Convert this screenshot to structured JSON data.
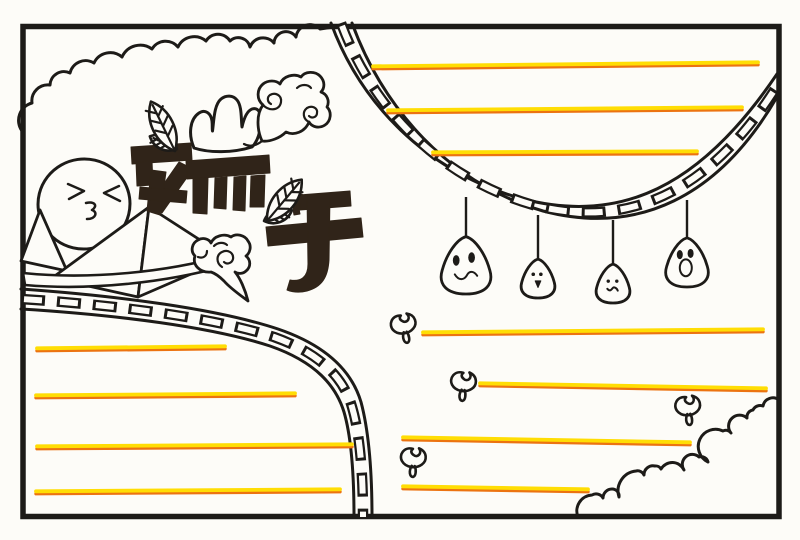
{
  "meta": {
    "title_text": "端午",
    "title_meaning": "Duanwu (Dragon Boat Festival) hand-drawn newspaper template",
    "artwork_kind": "black-ink doodle border page with blank writing lines"
  },
  "palette": {
    "paper": "#fdfcf8",
    "ink": "#1d1b18",
    "title_ink": "#302419",
    "line_yellow": "#ffdd04",
    "line_orange": "#ec7311"
  },
  "frame": {
    "x": 23,
    "y": 26.5,
    "w": 756,
    "h": 490,
    "stroke_w": 5.5
  },
  "writing_lines": {
    "top_right": [
      {
        "x1": 373,
        "y1": 67,
        "x2": 758,
        "y2": 63
      },
      {
        "x1": 388,
        "y1": 111,
        "x2": 742,
        "y2": 108
      },
      {
        "x1": 433,
        "y1": 153,
        "x2": 697,
        "y2": 152
      }
    ],
    "mid_right": [
      {
        "x1": 423,
        "y1": 333,
        "x2": 763,
        "y2": 330
      }
    ],
    "bottom_right": [
      {
        "x1": 480,
        "y1": 384,
        "x2": 766,
        "y2": 389
      },
      {
        "x1": 403,
        "y1": 438,
        "x2": 690,
        "y2": 443
      },
      {
        "x1": 403,
        "y1": 487,
        "x2": 588,
        "y2": 490
      }
    ],
    "bottom_left": [
      {
        "x1": 37,
        "y1": 349,
        "x2": 225,
        "y2": 347
      },
      {
        "x1": 36,
        "y1": 396,
        "x2": 295,
        "y2": 394
      },
      {
        "x1": 37,
        "y1": 447,
        "x2": 352,
        "y2": 445
      },
      {
        "x1": 36,
        "y1": 492,
        "x2": 340,
        "y2": 490
      }
    ]
  },
  "sprout_leaves": [
    {
      "x": 405,
      "y": 328,
      "r": -10
    },
    {
      "x": 464,
      "y": 386,
      "r": 6
    },
    {
      "x": 689,
      "y": 410,
      "r": -4
    },
    {
      "x": 414,
      "y": 462,
      "r": 4
    }
  ],
  "hanging_zongzi": [
    {
      "x": 466,
      "string_top": 197,
      "cy": 266,
      "scale": 1.4,
      "face": "smile"
    },
    {
      "x": 538,
      "string_top": 215,
      "cy": 279,
      "scale": 0.95,
      "face": "open-small"
    },
    {
      "x": 613,
      "string_top": 220,
      "cy": 284,
      "scale": 0.95,
      "face": "wavy"
    },
    {
      "x": 687,
      "string_top": 200,
      "cy": 263,
      "scale": 1.2,
      "face": "open-big"
    }
  ],
  "boat_zongzi": {
    "face": "kissy",
    "cx": 84,
    "cy": 204
  }
}
